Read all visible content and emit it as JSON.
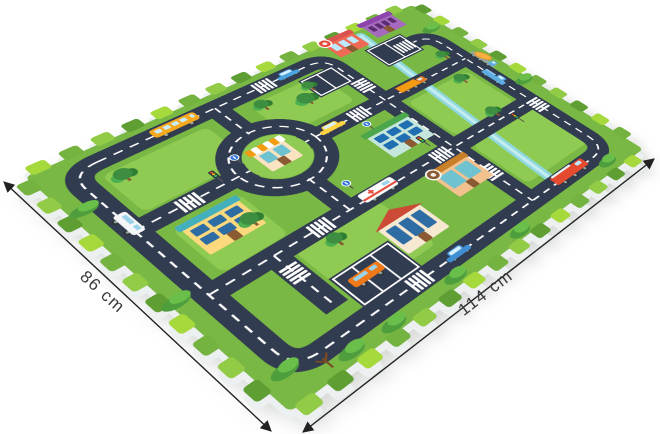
{
  "image_type": "product-photo-of-foam-puzzle-play-mat",
  "background": "#ffffff",
  "dimensions": [
    {
      "label": "86 cm",
      "from": [
        4,
        182
      ],
      "to": [
        271,
        431
      ],
      "label_pos": [
        99,
        296
      ],
      "angle": 42
    },
    {
      "label": "114 cm",
      "from": [
        303,
        432
      ],
      "to": [
        654,
        159
      ],
      "label_pos": [
        489,
        297
      ],
      "angle": -37.5
    }
  ],
  "mat": {
    "design_width": 520,
    "design_height": 392,
    "src": [
      16,
      16,
      536,
      16,
      536,
      408,
      16,
      408
    ],
    "dst": [
      25,
      177,
      412,
      5,
      643,
      149,
      290,
      412
    ],
    "side_dst": [
      24,
      184,
      411,
      10,
      646,
      156,
      290,
      421
    ],
    "foam_side_color": "#edf0f0",
    "tab": {
      "step": 34,
      "width": 20,
      "depth": 13,
      "palette": [
        "#a6d93c",
        "#74b340",
        "#92cb45",
        "#5f9e33"
      ]
    }
  },
  "scene": {
    "grass": {
      "base": "#79b844",
      "patch_color": "#8fca52",
      "patches": [
        [
          52,
          44,
          120,
          70
        ],
        [
          228,
          44,
          96,
          64
        ],
        [
          56,
          152,
          76,
          76
        ],
        [
          368,
          150,
          100,
          80
        ],
        [
          120,
          252,
          108,
          84
        ],
        [
          368,
          255,
          112,
          84
        ]
      ]
    },
    "stream": {
      "path": "M 418 14 C 410 120 400 240 394 356",
      "color": "#8fd8de",
      "core": "#c2ecef"
    },
    "roads": {
      "color": "#323c50",
      "line_color": "#ffffff",
      "width": 26,
      "paths": [
        "M 60 23 Q 31 23 31 52 V 332 Q 31 361 60 361 H 458 Q 487 361 487 332 V 92 Q 487 64 462 64 H 430",
        "M 60 23 H 325 Q 351 23 351 49 V 361",
        "M 31 130 H 487",
        "M 31 242 H 487",
        "M 198 23 V 82",
        "M 198 178 V 242",
        "M 103 242 V 332"
      ],
      "roundabout": {
        "cx": 198,
        "cy": 130,
        "r": 50,
        "island_r": 36,
        "island_color": "#8fca52"
      }
    },
    "parking_lots": [
      {
        "x": 400,
        "y": 40,
        "w": 60,
        "h": 44,
        "dividers": 1
      },
      {
        "x": 120,
        "y": 300,
        "w": 76,
        "h": 50,
        "dividers": 2
      },
      {
        "x": 298,
        "y": 40,
        "w": 50,
        "h": 40,
        "dividers": 1
      }
    ],
    "crossings": [
      [
        263,
        23,
        0
      ],
      [
        90,
        130,
        0
      ],
      [
        310,
        130,
        0
      ],
      [
        160,
        242,
        0
      ],
      [
        330,
        242,
        0
      ],
      [
        180,
        361,
        0
      ],
      [
        351,
        92,
        90
      ],
      [
        351,
        298,
        90
      ],
      [
        487,
        252,
        90
      ],
      [
        445,
        64,
        0
      ],
      [
        103,
        272,
        90
      ]
    ],
    "buildings": [
      {
        "name": "school",
        "x": 62,
        "y": 158,
        "w": 64,
        "h": 44,
        "wall": "#fdd97d",
        "roof": "flat",
        "roof_color": "#45b0bd",
        "win": "#2e6da4",
        "rows": 2,
        "cols": 3
      },
      {
        "name": "supermarket",
        "x": 288,
        "y": 168,
        "w": 62,
        "h": 44,
        "wall": "#c5e6da",
        "roof": "flat",
        "roof_color": "#4ca64c",
        "win": "#1f6fb2",
        "rows": 2,
        "cols": 3
      },
      {
        "name": "bakery",
        "x": 296,
        "y": 262,
        "w": 54,
        "h": 42,
        "wall": "#f2c18d",
        "roof": "flat",
        "roof_color": "#c97f28",
        "win": "#6fc2d0",
        "rows": 1,
        "cols": 2,
        "sign": "#8a5a33"
      },
      {
        "name": "red-roof-house",
        "x": 198,
        "y": 284,
        "w": 58,
        "h": 44,
        "wall": "#f7e8d2",
        "roof": "gable",
        "roof_color": "#cc4b37",
        "win": "#2e6da4",
        "rows": 1,
        "cols": 3
      },
      {
        "name": "pizza-shop",
        "x": 368,
        "y": 2,
        "w": 46,
        "h": 32,
        "wall": "#ef6a55",
        "roof": "flat",
        "roof_color": "#d9534f",
        "win": "#bfe9ff",
        "rows": 1,
        "cols": 3,
        "sign": "#e74c3c"
      },
      {
        "name": "purple-theater",
        "x": 432,
        "y": 0,
        "w": 50,
        "h": 30,
        "wall": "#a569bd",
        "roof": "flat",
        "roof_color": "#8e44ad",
        "win": "#5b2c6f",
        "rows": 1,
        "cols": 4
      },
      {
        "name": "roundabout-shop",
        "x": 178,
        "y": 112,
        "w": 40,
        "h": 34,
        "wall": "#fbe3c2",
        "roof": "awning",
        "roof_color": "#f39c12",
        "win": "#6fc2d0",
        "rows": 1,
        "cols": 2
      }
    ],
    "vehicles": [
      {
        "name": "school-bus",
        "type": "bus",
        "x": 150,
        "y": 23,
        "rot": 0,
        "w": 54,
        "h": 20,
        "body": "#f6a91e",
        "win": "#c9ecff"
      },
      {
        "name": "blue-car",
        "type": "car",
        "x": 298,
        "y": 22,
        "rot": 0,
        "w": 30,
        "h": 15,
        "body": "#4aa3df",
        "win": "#d6f1ff"
      },
      {
        "name": "white-van",
        "type": "van",
        "x": 31,
        "y": 118,
        "rot": 90,
        "w": 34,
        "h": 18,
        "body": "#f4f6f7",
        "win": "#9bd3ea"
      },
      {
        "name": "taxi",
        "type": "taxi",
        "x": 272,
        "y": 129,
        "rot": 0,
        "w": 34,
        "h": 15,
        "body": "#ffd23f",
        "win": "#d6f1ff"
      },
      {
        "name": "dump-truck",
        "type": "truck",
        "x": 398,
        "y": 128,
        "rot": 0,
        "w": 44,
        "h": 19,
        "body": "#f39c12",
        "win": "#d6f1ff"
      },
      {
        "name": "ambulance",
        "type": "ambulance",
        "x": 240,
        "y": 241,
        "rot": 0,
        "w": 46,
        "h": 20,
        "body": "#ffffff",
        "win": "#9bd3ea",
        "accent": "#e74c3c"
      },
      {
        "name": "fire-truck",
        "type": "fire",
        "x": 420,
        "y": 360,
        "rot": 0,
        "w": 56,
        "h": 21,
        "body": "#e64a2e",
        "win": "#bfe9ff"
      },
      {
        "name": "blue-hatchback",
        "type": "car",
        "x": 235,
        "y": 360,
        "rot": 0,
        "w": 32,
        "h": 15,
        "body": "#3f8fd2",
        "win": "#d6f1ff"
      },
      {
        "name": "orange-minivan",
        "type": "van",
        "x": 150,
        "y": 322,
        "rot": 0,
        "w": 38,
        "h": 18,
        "body": "#f07818",
        "win": "#9bd3ea"
      },
      {
        "name": "blue-pickup",
        "type": "pickup",
        "x": 487,
        "y": 180,
        "rot": 90,
        "w": 36,
        "h": 18,
        "body": "#5dade2",
        "win": "#d6f1ff"
      },
      {
        "name": "cement-mixer",
        "type": "mixer",
        "x": 506,
        "y": 145,
        "rot": 90,
        "w": 40,
        "h": 20,
        "body": "#95a5a6",
        "win": "#d6f1ff",
        "accent": "#f5b041"
      }
    ],
    "trees": [
      [
        68,
        58,
        9
      ],
      [
        240,
        52,
        8
      ],
      [
        284,
        74,
        10
      ],
      [
        118,
        190,
        9
      ],
      [
        452,
        158,
        8
      ],
      [
        470,
        108,
        7
      ],
      [
        160,
        266,
        8
      ],
      [
        434,
        228,
        8
      ],
      [
        302,
        56,
        7
      ],
      [
        55,
        372,
        0
      ]
    ],
    "bushes": [
      [
        78,
        380
      ],
      [
        126,
        383
      ],
      [
        468,
        377
      ],
      [
        24,
        356
      ],
      [
        14,
        76
      ],
      [
        512,
        208
      ],
      [
        210,
        381
      ],
      [
        305,
        383
      ],
      [
        500,
        56
      ],
      [
        6,
        230
      ]
    ],
    "signs": [
      [
        163,
        106,
        "blue"
      ],
      [
        305,
        152,
        "blue"
      ],
      [
        222,
        212,
        "blue"
      ],
      [
        332,
        215,
        "light"
      ],
      [
        448,
        256,
        "light"
      ],
      [
        132,
        118,
        "light"
      ]
    ]
  }
}
